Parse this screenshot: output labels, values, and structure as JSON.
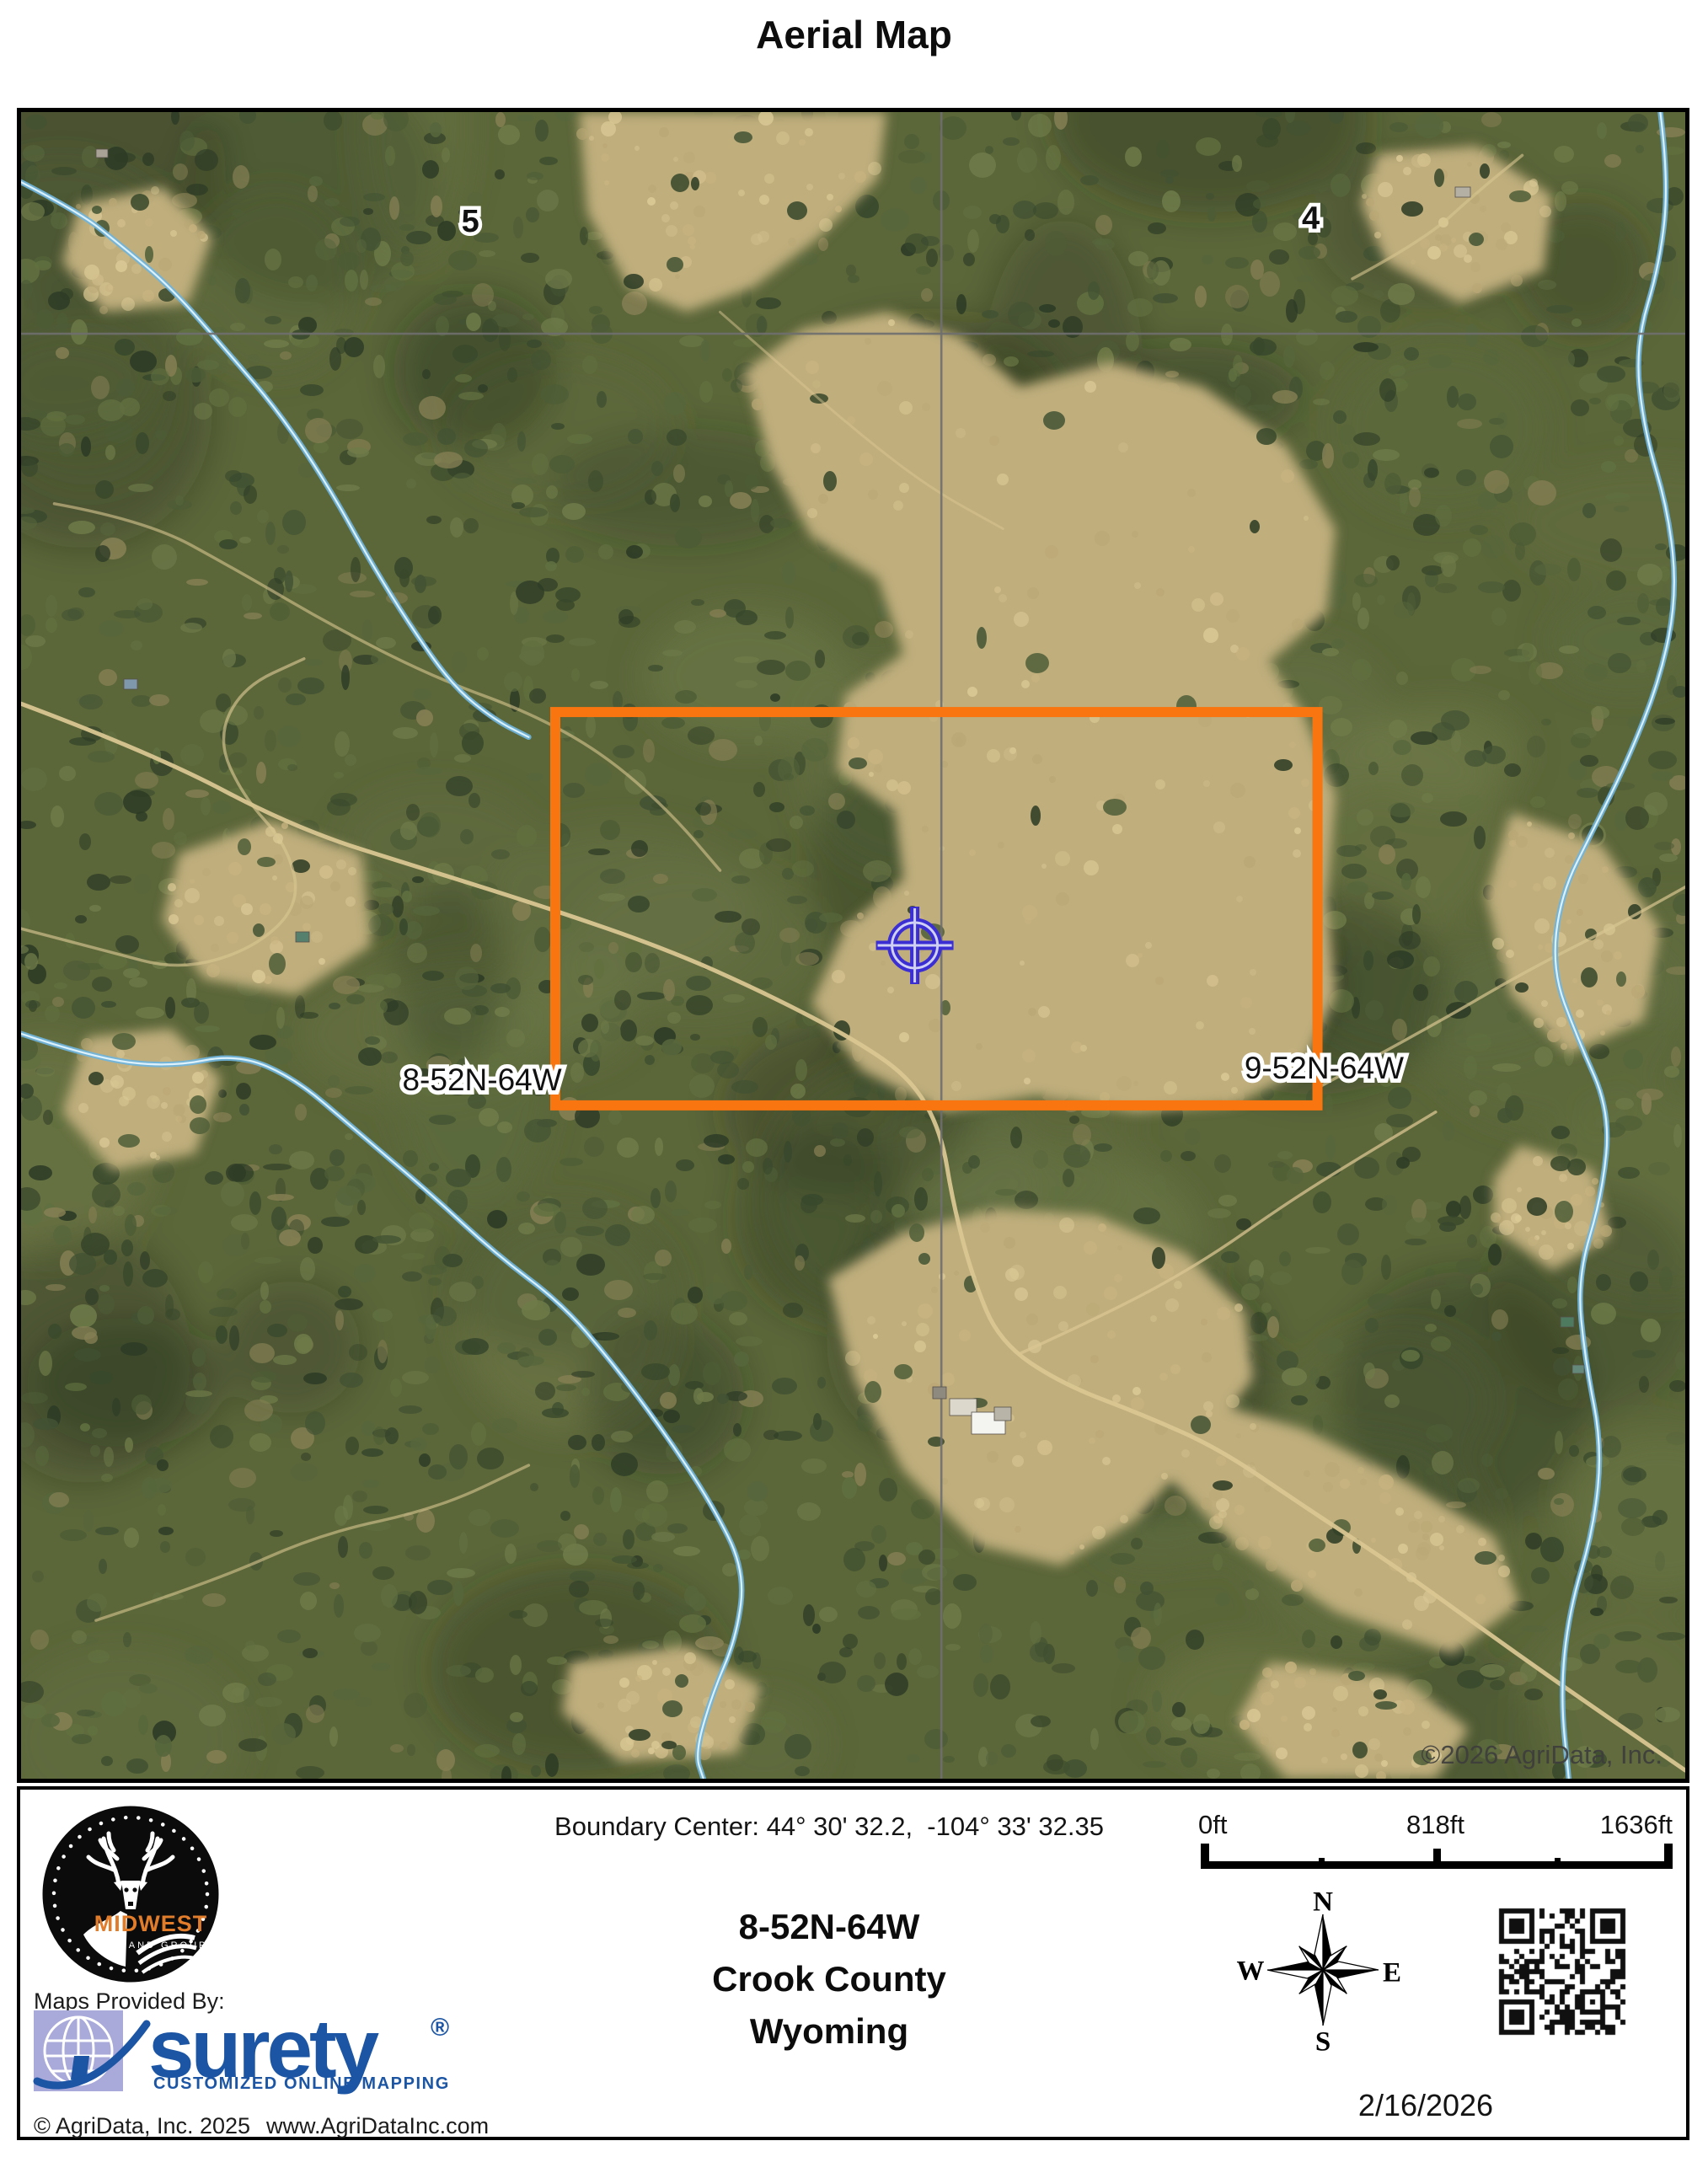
{
  "page": {
    "title": "Aerial Map"
  },
  "map": {
    "watermark": "©2026 AgriData, Inc.",
    "section_numbers": [
      {
        "label": "5",
        "x": 0.27,
        "y": 0.0667
      },
      {
        "label": "4",
        "x": 0.775,
        "y": 0.065
      }
    ],
    "parcel_labels": [
      {
        "label": "8-52N-64W",
        "x": 0.277,
        "y": 0.582
      },
      {
        "label": "9-52N-64W",
        "x": 0.783,
        "y": 0.575
      }
    ],
    "boundary": {
      "color": "#F8750F",
      "x0": 0.321,
      "y0": 0.36,
      "x1": 0.779,
      "y1": 0.596,
      "stroke_width": 12
    },
    "marker": {
      "color": "#3B2FD4",
      "x": 0.537,
      "y": 0.5
    },
    "section_lines": {
      "color": "#6F6F6F",
      "vertical_x": 0.553,
      "horizontal_y": 0.133
    },
    "palette": {
      "forest_base": "#5b6639",
      "forest_speckle": [
        "#2d3b26",
        "#38482c",
        "#425233",
        "#4d5c36",
        "#57663c",
        "#617040",
        "#6f7b49"
      ],
      "forest_khaki": "#857f54",
      "light_patch": [
        "#6b7848",
        "#76814d",
        "#5f6e41"
      ],
      "dark_patch": [
        "#25301d",
        "#1e281a"
      ],
      "meadow_fill": "#c0ae7d",
      "meadow_speckle": [
        "#d2c08d",
        "#c8b480",
        "#baa876",
        "#dccb97"
      ],
      "clump": [
        "#3a4a2c",
        "#465636",
        "#2f3d25",
        "#52613a"
      ],
      "road": "#d9c691",
      "creek_outer": "#6fb4dc",
      "creek_inner": "#e2f4fd",
      "watermark_color": "#3d3d3d",
      "label_fill": "#111111",
      "label_halo": "#ffffff"
    },
    "meadows": [
      [
        0.335,
        0.0,
        0.52,
        0.0,
        0.515,
        0.04,
        0.48,
        0.075,
        0.44,
        0.105,
        0.4,
        0.12,
        0.365,
        0.105,
        0.34,
        0.06
      ],
      [
        0.435,
        0.155,
        0.47,
        0.13,
        0.52,
        0.12,
        0.565,
        0.135,
        0.6,
        0.165,
        0.655,
        0.15,
        0.71,
        0.165,
        0.76,
        0.2,
        0.79,
        0.25,
        0.785,
        0.3,
        0.75,
        0.33,
        0.77,
        0.36,
        0.79,
        0.41,
        0.785,
        0.47,
        0.79,
        0.53,
        0.77,
        0.575,
        0.73,
        0.595,
        0.67,
        0.6,
        0.61,
        0.59,
        0.555,
        0.6,
        0.505,
        0.575,
        0.475,
        0.535,
        0.495,
        0.49,
        0.53,
        0.46,
        0.525,
        0.42,
        0.49,
        0.395,
        0.495,
        0.35,
        0.53,
        0.325,
        0.515,
        0.28,
        0.475,
        0.255,
        0.45,
        0.21
      ],
      [
        0.485,
        0.7,
        0.53,
        0.672,
        0.585,
        0.658,
        0.645,
        0.662,
        0.7,
        0.685,
        0.735,
        0.72,
        0.74,
        0.76,
        0.71,
        0.8,
        0.67,
        0.845,
        0.625,
        0.872,
        0.575,
        0.86,
        0.53,
        0.815,
        0.5,
        0.76
      ],
      [
        0.7,
        0.77,
        0.77,
        0.79,
        0.83,
        0.82,
        0.885,
        0.855,
        0.9,
        0.895,
        0.86,
        0.925,
        0.79,
        0.9,
        0.73,
        0.86,
        0.69,
        0.82
      ],
      [
        0.895,
        0.42,
        0.95,
        0.44,
        0.985,
        0.49,
        0.975,
        0.545,
        0.93,
        0.565,
        0.895,
        0.53,
        0.88,
        0.47
      ],
      [
        0.095,
        0.445,
        0.15,
        0.425,
        0.205,
        0.445,
        0.21,
        0.5,
        0.165,
        0.53,
        0.11,
        0.52,
        0.085,
        0.485
      ],
      [
        0.04,
        0.555,
        0.09,
        0.55,
        0.12,
        0.58,
        0.105,
        0.625,
        0.055,
        0.635,
        0.025,
        0.6
      ],
      [
        0.035,
        0.055,
        0.085,
        0.045,
        0.115,
        0.075,
        0.1,
        0.115,
        0.05,
        0.12,
        0.025,
        0.09
      ],
      [
        0.815,
        0.025,
        0.875,
        0.02,
        0.92,
        0.05,
        0.915,
        0.095,
        0.865,
        0.115,
        0.82,
        0.09,
        0.805,
        0.055
      ],
      [
        0.9,
        0.62,
        0.945,
        0.635,
        0.955,
        0.675,
        0.92,
        0.695,
        0.885,
        0.67,
        0.885,
        0.64
      ],
      [
        0.33,
        0.93,
        0.4,
        0.92,
        0.445,
        0.945,
        0.43,
        0.985,
        0.36,
        0.99,
        0.325,
        0.96
      ],
      [
        0.75,
        0.93,
        0.83,
        0.94,
        0.87,
        0.97,
        0.85,
        1.0,
        0.76,
        1.0,
        0.73,
        0.965
      ]
    ],
    "roads": [
      {
        "w": 5.0,
        "o": 0.95,
        "pts": [
          [
            0,
            0.355
          ],
          [
            0.08,
            0.385
          ],
          [
            0.165,
            0.43
          ],
          [
            0.245,
            0.455
          ],
          [
            0.315,
            0.477
          ],
          [
            0.39,
            0.503
          ],
          [
            0.45,
            0.53
          ],
          [
            0.5,
            0.556
          ],
          [
            0.535,
            0.58
          ],
          [
            0.553,
            0.612
          ],
          [
            0.56,
            0.655
          ],
          [
            0.572,
            0.7
          ],
          [
            0.588,
            0.738
          ],
          [
            0.625,
            0.763
          ],
          [
            0.675,
            0.782
          ],
          [
            0.72,
            0.802
          ],
          [
            0.77,
            0.836
          ],
          [
            0.825,
            0.872
          ],
          [
            0.875,
            0.908
          ],
          [
            0.93,
            0.947
          ],
          [
            1.0,
            0.995
          ]
        ]
      },
      {
        "w": 3.5,
        "o": 0.6,
        "pts": [
          [
            0.02,
            0.235
          ],
          [
            0.075,
            0.245
          ],
          [
            0.13,
            0.275
          ],
          [
            0.19,
            0.31
          ],
          [
            0.25,
            0.34
          ],
          [
            0.305,
            0.36
          ],
          [
            0.35,
            0.385
          ],
          [
            0.39,
            0.42
          ],
          [
            0.42,
            0.455
          ]
        ]
      },
      {
        "w": 3.5,
        "o": 0.7,
        "pts": [
          [
            0.78,
            0.585
          ],
          [
            0.845,
            0.55
          ],
          [
            0.905,
            0.515
          ],
          [
            0.955,
            0.49
          ],
          [
            1.0,
            0.465
          ]
        ]
      },
      {
        "w": 3.5,
        "o": 0.65,
        "pts": [
          [
            0.0,
            0.49
          ],
          [
            0.05,
            0.503
          ],
          [
            0.095,
            0.515
          ],
          [
            0.14,
            0.502
          ],
          [
            0.168,
            0.475
          ],
          [
            0.16,
            0.44
          ],
          [
            0.133,
            0.41
          ],
          [
            0.118,
            0.376
          ],
          [
            0.133,
            0.345
          ],
          [
            0.17,
            0.328
          ]
        ]
      },
      {
        "w": 3.5,
        "o": 0.6,
        "pts": [
          [
            0.8,
            0.1
          ],
          [
            0.843,
            0.077
          ],
          [
            0.875,
            0.048
          ],
          [
            0.902,
            0.026
          ]
        ]
      },
      {
        "w": 3.5,
        "o": 0.6,
        "pts": [
          [
            0.045,
            0.905
          ],
          [
            0.115,
            0.882
          ],
          [
            0.18,
            0.853
          ],
          [
            0.25,
            0.838
          ],
          [
            0.305,
            0.812
          ]
        ]
      },
      {
        "w": 3.5,
        "o": 0.75,
        "pts": [
          [
            0.6,
            0.745
          ],
          [
            0.655,
            0.72
          ],
          [
            0.71,
            0.69
          ],
          [
            0.76,
            0.655
          ],
          [
            0.8,
            0.63
          ],
          [
            0.85,
            0.6
          ]
        ]
      },
      {
        "w": 3.0,
        "o": 0.5,
        "pts": [
          [
            0.42,
            0.12
          ],
          [
            0.46,
            0.155
          ],
          [
            0.5,
            0.19
          ],
          [
            0.545,
            0.225
          ],
          [
            0.59,
            0.25
          ]
        ]
      }
    ],
    "creeks": [
      [
        [
          0.0,
          0.042
        ],
        [
          0.035,
          0.06
        ],
        [
          0.06,
          0.08
        ],
        [
          0.09,
          0.105
        ],
        [
          0.125,
          0.145
        ],
        [
          0.155,
          0.18
        ],
        [
          0.185,
          0.225
        ],
        [
          0.21,
          0.27
        ],
        [
          0.235,
          0.31
        ],
        [
          0.26,
          0.345
        ],
        [
          0.285,
          0.365
        ],
        [
          0.305,
          0.375
        ]
      ],
      [
        [
          0.0,
          0.553
        ],
        [
          0.045,
          0.568
        ],
        [
          0.09,
          0.573
        ],
        [
          0.13,
          0.565
        ],
        [
          0.165,
          0.58
        ],
        [
          0.2,
          0.61
        ],
        [
          0.245,
          0.648
        ],
        [
          0.285,
          0.685
        ],
        [
          0.325,
          0.715
        ],
        [
          0.355,
          0.75
        ],
        [
          0.385,
          0.79
        ],
        [
          0.415,
          0.835
        ],
        [
          0.435,
          0.875
        ],
        [
          0.43,
          0.915
        ],
        [
          0.415,
          0.95
        ],
        [
          0.405,
          0.985
        ],
        [
          0.41,
          1.0
        ]
      ],
      [
        [
          0.985,
          0.0
        ],
        [
          0.99,
          0.04
        ],
        [
          0.985,
          0.09
        ],
        [
          0.97,
          0.14
        ],
        [
          0.975,
          0.19
        ],
        [
          0.99,
          0.24
        ],
        [
          0.995,
          0.29
        ],
        [
          0.985,
          0.34
        ],
        [
          0.965,
          0.39
        ],
        [
          0.945,
          0.43
        ],
        [
          0.925,
          0.47
        ],
        [
          0.92,
          0.515
        ],
        [
          0.935,
          0.555
        ],
        [
          0.955,
          0.6
        ],
        [
          0.95,
          0.65
        ],
        [
          0.935,
          0.7
        ],
        [
          0.94,
          0.75
        ],
        [
          0.95,
          0.8
        ],
        [
          0.945,
          0.85
        ],
        [
          0.93,
          0.9
        ],
        [
          0.925,
          0.95
        ],
        [
          0.93,
          1.0
        ]
      ]
    ],
    "buildings": [
      [
        0.558,
        0.772,
        0.016,
        0.01,
        "#ddd8cc"
      ],
      [
        0.571,
        0.78,
        0.02,
        0.013,
        "#f4f4f0"
      ],
      [
        0.585,
        0.777,
        0.01,
        0.008,
        "#b9b4a8"
      ],
      [
        0.548,
        0.765,
        0.008,
        0.007,
        "#8f8a80"
      ],
      [
        0.062,
        0.34,
        0.008,
        0.006,
        "#7f98ac"
      ],
      [
        0.165,
        0.492,
        0.008,
        0.006,
        "#56806e"
      ],
      [
        0.925,
        0.723,
        0.008,
        0.006,
        "#4e7a60"
      ],
      [
        0.932,
        0.752,
        0.007,
        0.005,
        "#64897a"
      ],
      [
        0.862,
        0.045,
        0.009,
        0.006,
        "#b5b0a4"
      ],
      [
        0.045,
        0.022,
        0.007,
        0.005,
        "#a8a296"
      ]
    ]
  },
  "footer": {
    "boundary_center": "Boundary Center: 44° 30' 32.2,  -104° 33' 32.35",
    "township": "8-52N-64W",
    "county": "Crook County",
    "state": "Wyoming",
    "scale": {
      "start": "0ft",
      "middle": "818ft",
      "end": "1636ft"
    },
    "compass": {
      "n": "N",
      "s": "S",
      "e": "E",
      "w": "W"
    },
    "date": "2/16/2026",
    "maps_provided_by": "Maps Provided By:",
    "midwest": {
      "name": "MIDWEST",
      "subtitle": "LAND GROUP",
      "name_color": "#e07c2a"
    },
    "surety": {
      "word": "surety",
      "registered": "®",
      "tagline": "CUSTOMIZED ONLINE MAPPING",
      "blue": "#1b55a4",
      "globe_bg": "#a9a9da"
    },
    "copyright": "© AgriData, Inc. 2025",
    "website": "www.AgriDataInc.com"
  }
}
